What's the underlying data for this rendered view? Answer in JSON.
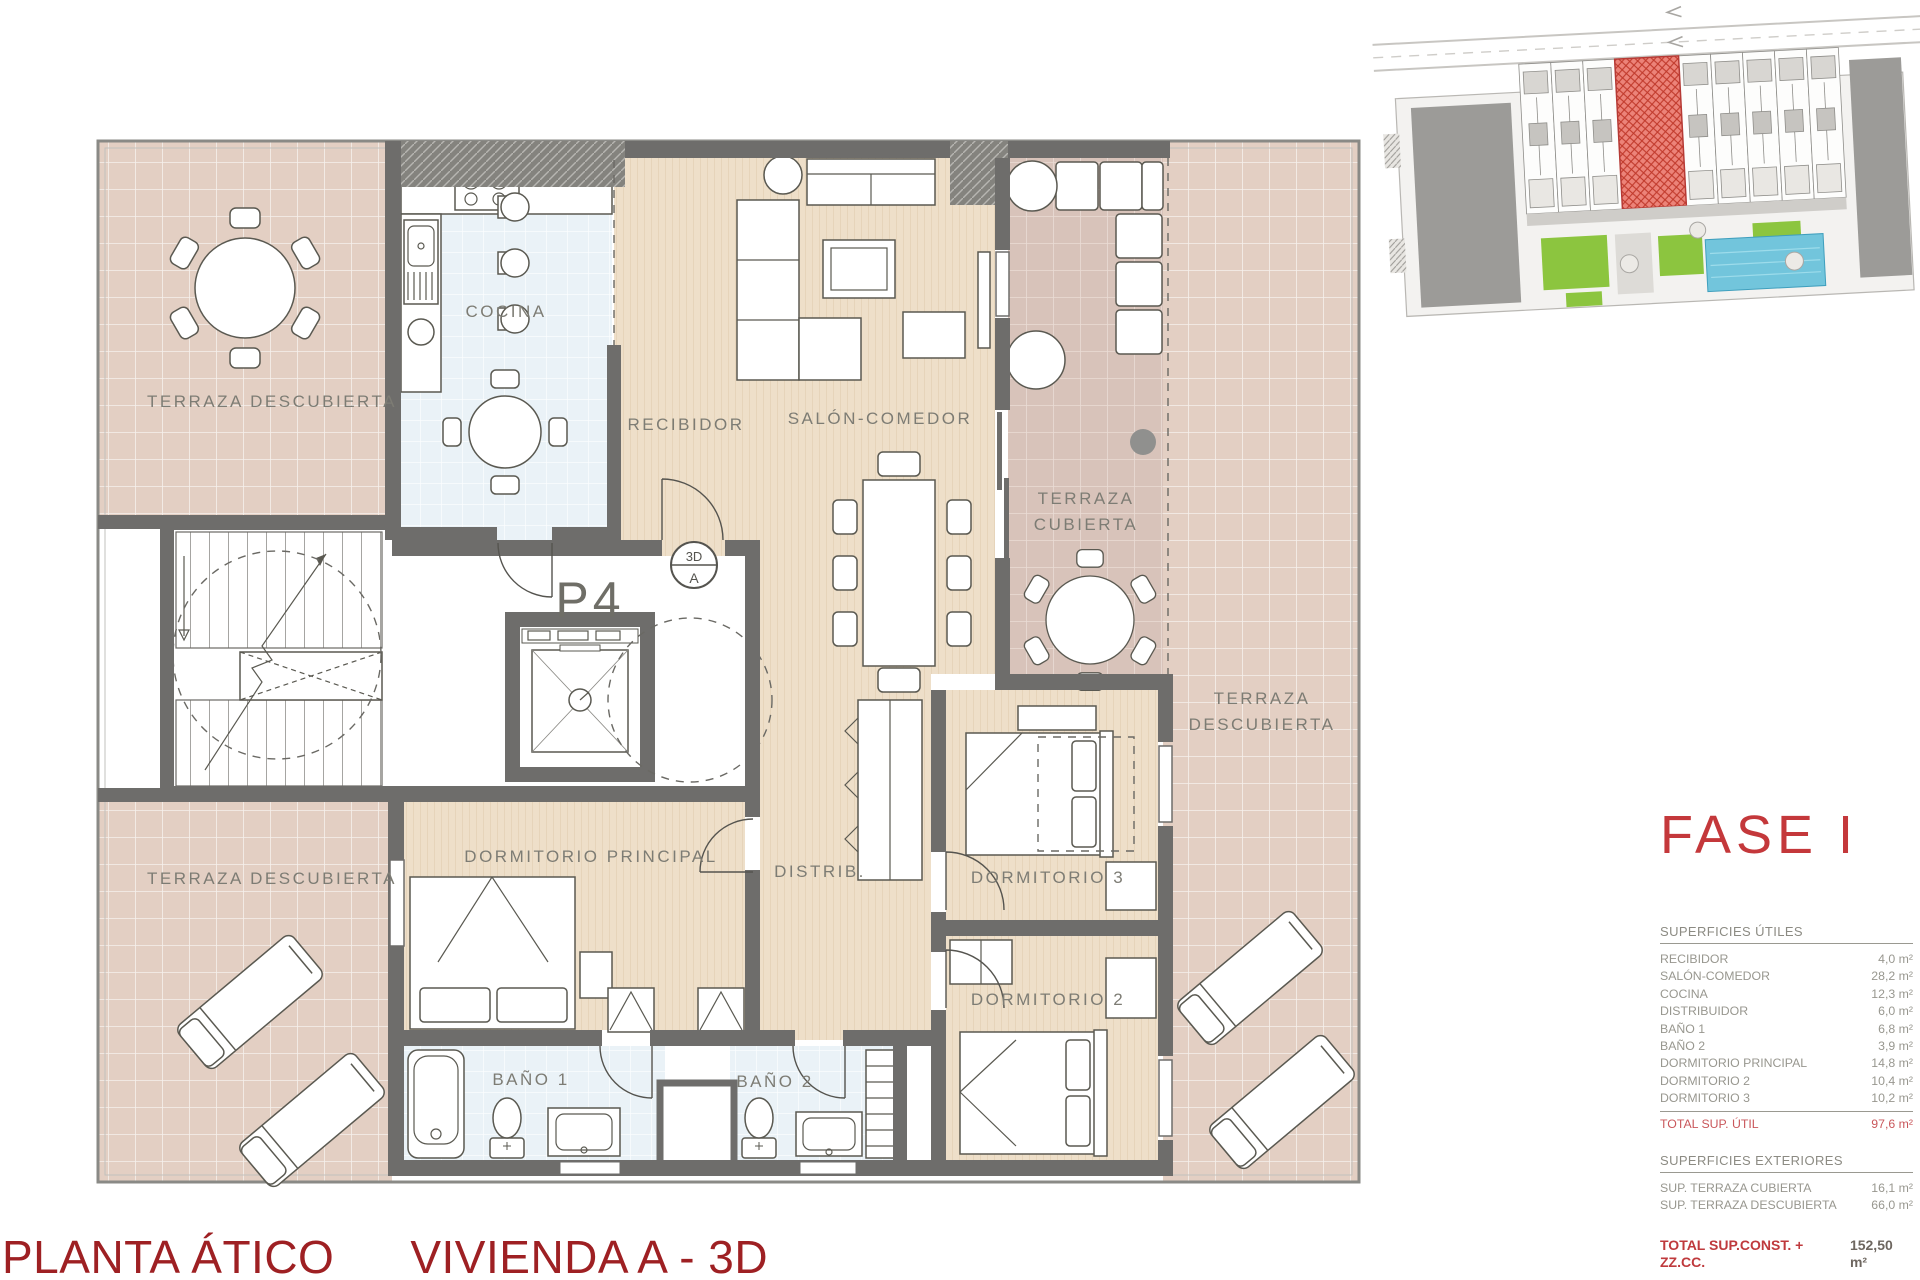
{
  "header": {
    "phase_label": "FASE I"
  },
  "floor_plan": {
    "unit_label": "P4",
    "marker_3d": {
      "top": "3D",
      "bottom": "A"
    },
    "room_labels": {
      "terraza_descubierta": "TERRAZA DESCUBIERTA",
      "cocina": "COCINA",
      "recibidor": "RECIBIDOR",
      "salon_comedor": "SALÓN-COMEDOR",
      "terraza_cubierta": "TERRAZA CUBIERTA",
      "dormitorio_principal": "DORMITORIO PRINCIPAL",
      "distribuidor": "DISTRIB.",
      "dormitorio_3": "DORMITORIO 3",
      "dormitorio_2": "DORMITORIO 2",
      "bano_1": "BAÑO 1",
      "bano_2": "BAÑO 2"
    }
  },
  "areas_table": {
    "utiles": {
      "header": "SUPERFICIES ÚTILES",
      "rows": [
        {
          "label": "RECIBIDOR",
          "value": "4,0 m²"
        },
        {
          "label": "SALÓN-COMEDOR",
          "value": "28,2 m²"
        },
        {
          "label": "COCINA",
          "value": "12,3 m²"
        },
        {
          "label": "DISTRIBUIDOR",
          "value": "6,0 m²"
        },
        {
          "label": "BAÑO 1",
          "value": "6,8 m²"
        },
        {
          "label": "BAÑO 2",
          "value": "3,9 m²"
        },
        {
          "label": "DORMITORIO PRINCIPAL",
          "value": "14,8 m²"
        },
        {
          "label": "DORMITORIO 2",
          "value": "10,4 m²"
        },
        {
          "label": "DORMITORIO 3",
          "value": "10,2 m²"
        }
      ],
      "total": {
        "label": "TOTAL SUP. ÚTIL",
        "value": "97,6 m²"
      }
    },
    "exteriores": {
      "header": "SUPERFICIES EXTERIORES",
      "rows": [
        {
          "label": "SUP. TERRAZA CUBIERTA",
          "value": "16,1 m²"
        },
        {
          "label": "SUP. TERRAZA DESCUBIERTA",
          "value": "66,0 m²"
        }
      ]
    },
    "total_construida": {
      "label": "TOTAL SUP.CONST. + ZZ.CC.",
      "value": "152,50 m²"
    }
  },
  "footer": {
    "plan_level": "PLANTA ÁTICO",
    "unit_name": "VIVIENDA A - 3D"
  },
  "colors": {
    "accent_red": "#c4383b",
    "footer_red": "#9e2023",
    "wall_gray": "#6e6d6b",
    "label_gray": "#7d7c74",
    "wood_floor": "#eedfc9",
    "terrace_tile": "#e3cfc3",
    "covered_terrace_tile": "#d8c3ba",
    "wet_room_tile": "#eaf2f7",
    "pool_blue": "#72c5dc",
    "grass_green": "#8cc53f",
    "site_highlight": "#ec8379"
  }
}
